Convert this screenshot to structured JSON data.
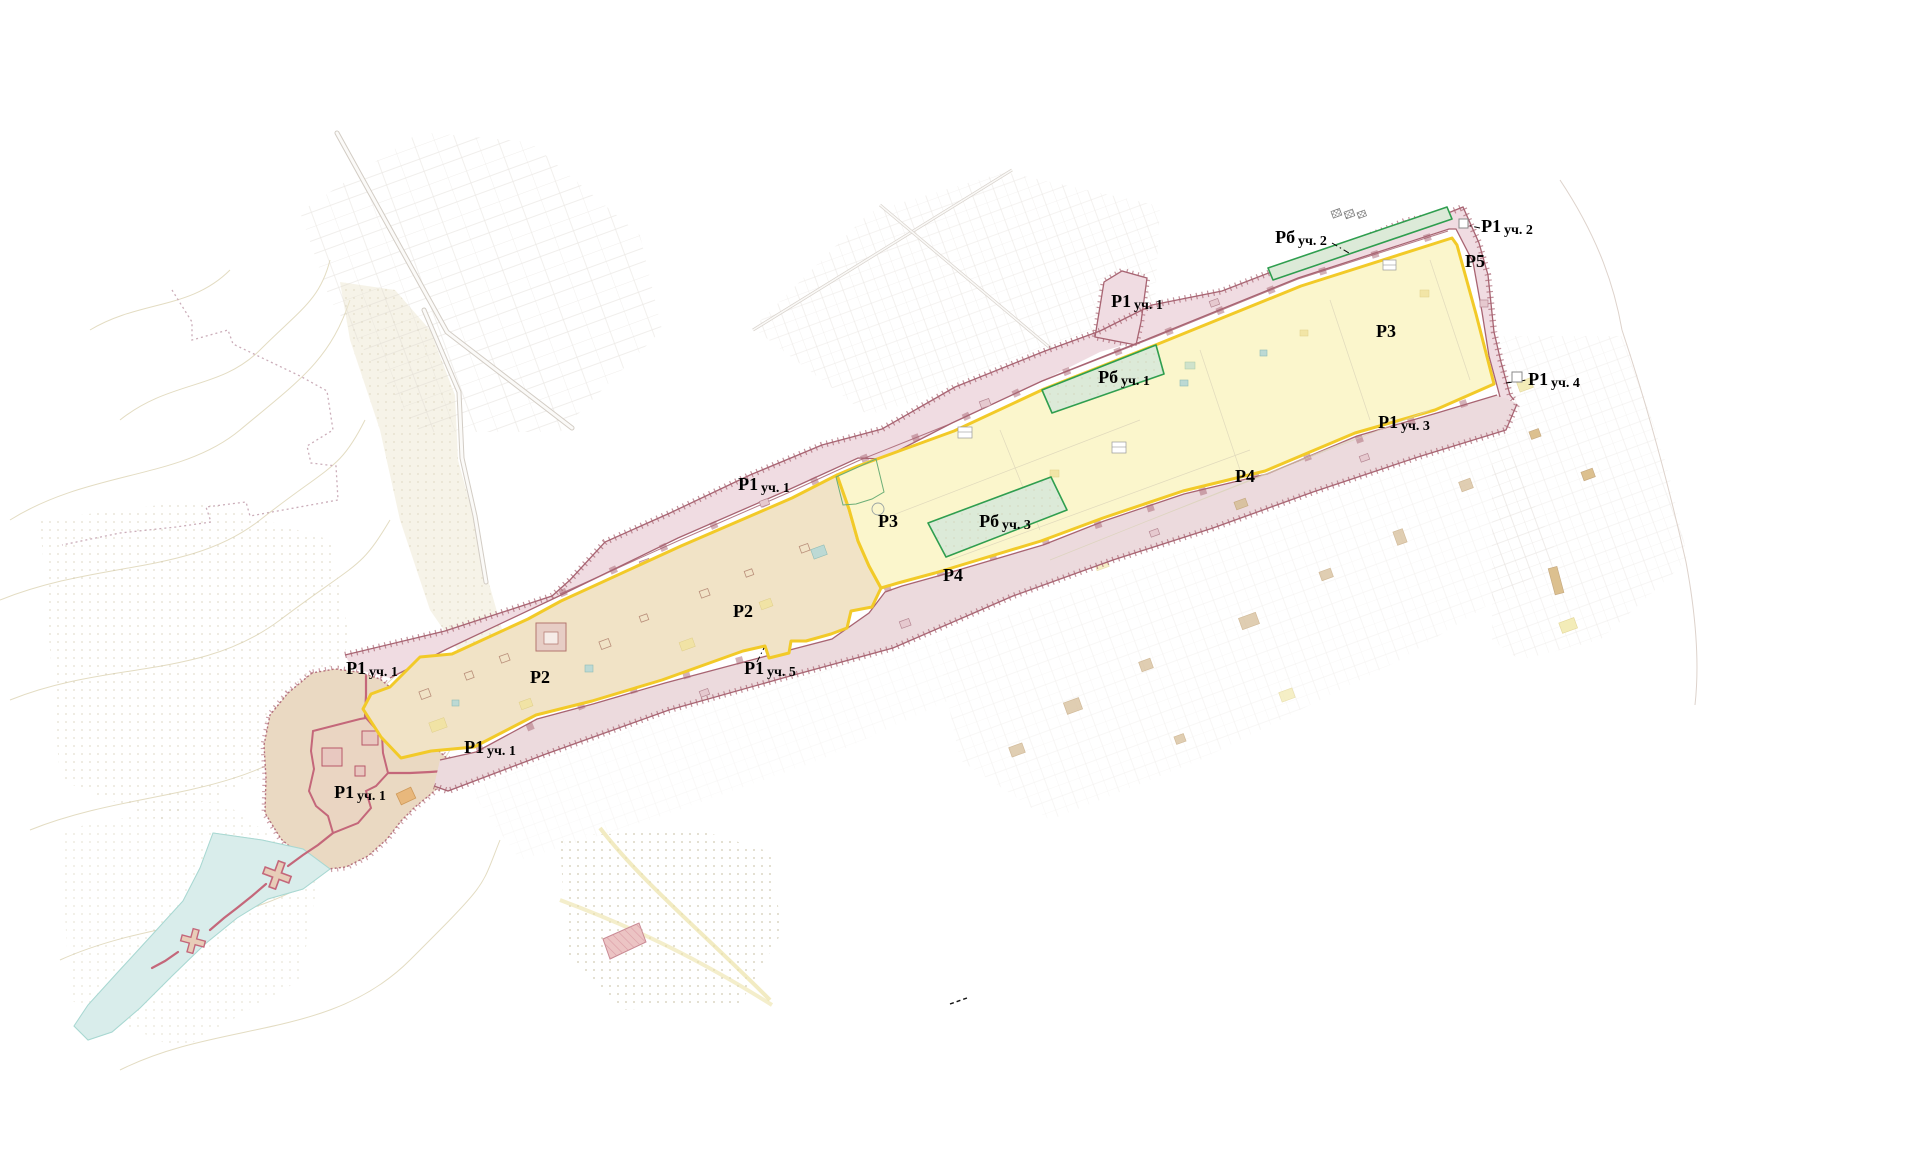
{
  "map": {
    "background_color": "#ffffff",
    "palette": {
      "zone_monument_tan": "#f1e3c6",
      "zone_monument_yellow": "#fbf6cc",
      "zone_border_yellow": "#f2ca28",
      "corridor_fill": "#f0dce2",
      "corridor_fill_lower": "#ecdadd",
      "corridor_border": "#a86472",
      "green_fill": "#dcead8",
      "green_border": "#2f9e4f",
      "blob_fill": "#ead9c2",
      "citadel_fill": "#ead2c2",
      "citadel_wall": "#c4677a",
      "river_fill": "#d9edeb",
      "pink_plot_fill": "#ecc4c4",
      "label_color": "#000000"
    },
    "labels": [
      {
        "id": "r6-u2",
        "main": "Рб",
        "sub": "уч. 2",
        "x": 1301,
        "y": 243
      },
      {
        "id": "r1-u2",
        "main": "Р1",
        "sub": "уч. 2",
        "x": 1507,
        "y": 232
      },
      {
        "id": "r5",
        "main": "Р5",
        "sub": "",
        "x": 1475,
        "y": 267
      },
      {
        "id": "r1-u1-north",
        "main": "Р1",
        "sub": "уч. 1",
        "x": 1137,
        "y": 307
      },
      {
        "id": "r3-east",
        "main": "Р3",
        "sub": "",
        "x": 1386,
        "y": 337
      },
      {
        "id": "r6-u1",
        "main": "Рб",
        "sub": "уч. 1",
        "x": 1124,
        "y": 383
      },
      {
        "id": "r1-u4",
        "main": "Р1",
        "sub": "уч. 4",
        "x": 1554,
        "y": 385
      },
      {
        "id": "r1-u3",
        "main": "Р1",
        "sub": "уч. 3",
        "x": 1404,
        "y": 428
      },
      {
        "id": "r1-u1-mid",
        "main": "Р1",
        "sub": "уч. 1",
        "x": 764,
        "y": 490
      },
      {
        "id": "r4-east",
        "main": "Р4",
        "sub": "",
        "x": 1245,
        "y": 482
      },
      {
        "id": "r3-west",
        "main": "Р3",
        "sub": "",
        "x": 888,
        "y": 527
      },
      {
        "id": "r6-u3",
        "main": "Рб",
        "sub": "уч. 3",
        "x": 1005,
        "y": 527
      },
      {
        "id": "r4-west",
        "main": "Р4",
        "sub": "",
        "x": 953,
        "y": 581
      },
      {
        "id": "r2-east",
        "main": "Р2",
        "sub": "",
        "x": 743,
        "y": 617
      },
      {
        "id": "r1-u1-west",
        "main": "Р1",
        "sub": "уч. 1",
        "x": 372,
        "y": 674
      },
      {
        "id": "r2-west",
        "main": "Р2",
        "sub": "",
        "x": 540,
        "y": 683
      },
      {
        "id": "r1-u5",
        "main": "Р1",
        "sub": "уч. 5",
        "x": 770,
        "y": 674
      },
      {
        "id": "r1-u1-sw",
        "main": "Р1",
        "sub": "уч. 1",
        "x": 490,
        "y": 753
      },
      {
        "id": "r1-u1-fortress",
        "main": "Р1",
        "sub": "уч. 1",
        "x": 360,
        "y": 798
      }
    ],
    "leaders": [
      {
        "id": "leader-r6-u2",
        "x1": 1332,
        "y1": 243,
        "x2": 1349,
        "y2": 253
      },
      {
        "id": "leader-r1-u2",
        "x1": 1461,
        "y1": 224,
        "x2": 1480,
        "y2": 228
      },
      {
        "id": "leader-r1-u4",
        "x1": 1506,
        "y1": 383,
        "x2": 1527,
        "y2": 380
      },
      {
        "id": "leader-r1-u5",
        "x1": 757,
        "y1": 662,
        "x2": 764,
        "y2": 648
      }
    ],
    "markers": [
      {
        "id": "marker-r1-u2",
        "x": 1459,
        "y": 219,
        "s": 9
      },
      {
        "id": "marker-r1-u4",
        "x": 1512,
        "y": 372,
        "s": 10
      }
    ]
  }
}
